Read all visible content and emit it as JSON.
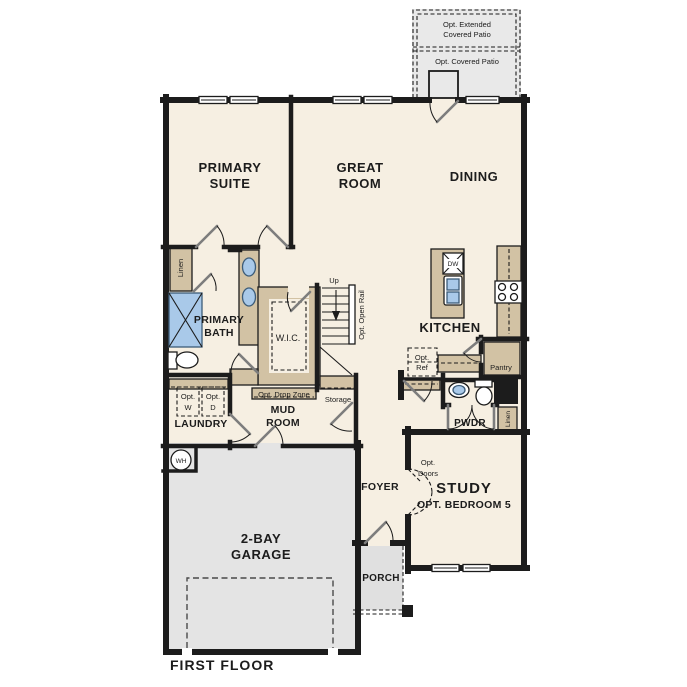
{
  "title": "FIRST FLOOR",
  "colors": {
    "floor": "#f6efe2",
    "garage": "#e4e4e4",
    "porch": "#e0e0e0",
    "patio": "#e9e9e9",
    "wall": "#1c1c1c",
    "cabinet": "#d2c2a4",
    "fixture_blue": "#a9c9e9",
    "door_leaf": "#7d7d7d"
  },
  "labels": {
    "patio_extended_l1": "Opt. Extended",
    "patio_extended_l2": "Covered Patio",
    "patio_covered": "Opt. Covered Patio",
    "primary_suite_l1": "PRIMARY",
    "primary_suite_l2": "SUITE",
    "great_room_l1": "GREAT",
    "great_room_l2": "ROOM",
    "dining": "DINING",
    "kitchen": "KITCHEN",
    "dw": "DW",
    "primary_bath_l1": "PRIMARY",
    "primary_bath_l2": "BATH",
    "linen_bath": "Linen",
    "wic": "W.I.C.",
    "up": "Up",
    "opt_open_rail": "Opt. Open Rail",
    "opt_ref_l1": "Opt.",
    "opt_ref_l2": "Ref",
    "pantry": "Pantry",
    "opt_w_l1": "Opt.",
    "opt_w_l2": "W",
    "opt_d_l1": "Opt.",
    "opt_d_l2": "D",
    "laundry": "LAUNDRY",
    "opt_drop_zone": "Opt. Drop Zone",
    "storage": "Storage",
    "mud_room_l1": "MUD",
    "mud_room_l2": "ROOM",
    "pwdr": "PWDR",
    "linen_hall": "Linen",
    "wh": "WH",
    "foyer": "FOYER",
    "opt_doors_l1": "Opt.",
    "opt_doors_l2": "Doors",
    "study": "STUDY",
    "study_sub": "OPT. BEDROOM 5",
    "garage_l1": "2-BAY",
    "garage_l2": "GARAGE",
    "porch": "PORCH"
  }
}
